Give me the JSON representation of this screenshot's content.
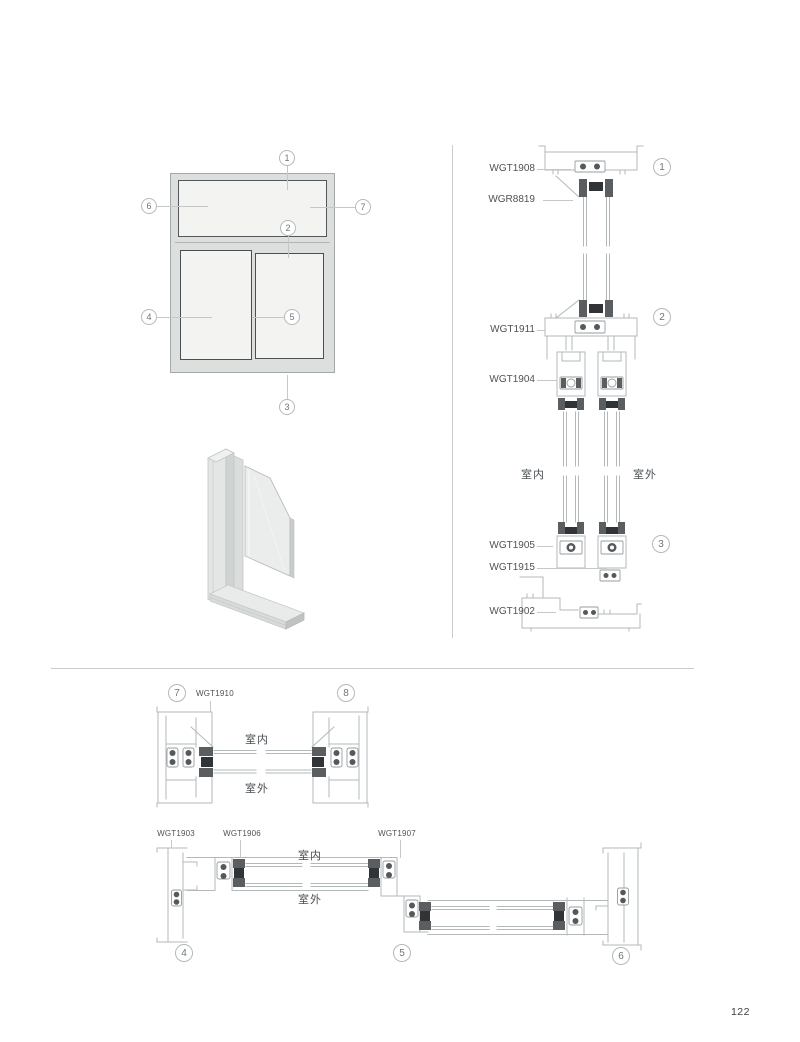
{
  "page": {
    "number": "122"
  },
  "elevation": {
    "callouts": [
      "1",
      "2",
      "3",
      "4",
      "5",
      "6",
      "7"
    ]
  },
  "vertical_section": {
    "callouts": [
      "1",
      "2",
      "3"
    ],
    "labels": {
      "l1908": "WGT1908",
      "l8819": "WGR8819",
      "l1911": "WGT1911",
      "l1904": "WGT1904",
      "l1905": "WGT1905",
      "l1915": "WGT1915",
      "l1902": "WGT1902"
    },
    "indoor": "室内",
    "outdoor": "室外"
  },
  "plan_fixed": {
    "callouts": [
      "7",
      "8"
    ],
    "labels": {
      "l1910": "WGT1910"
    },
    "indoor": "室内",
    "outdoor": "室外"
  },
  "plan_sliding": {
    "callouts": [
      "4",
      "5",
      "6"
    ],
    "labels": {
      "l1903": "WGT1903",
      "l1906": "WGT1906",
      "l1907": "WGT1907"
    },
    "indoor": "室内",
    "outdoor": "室外"
  }
}
